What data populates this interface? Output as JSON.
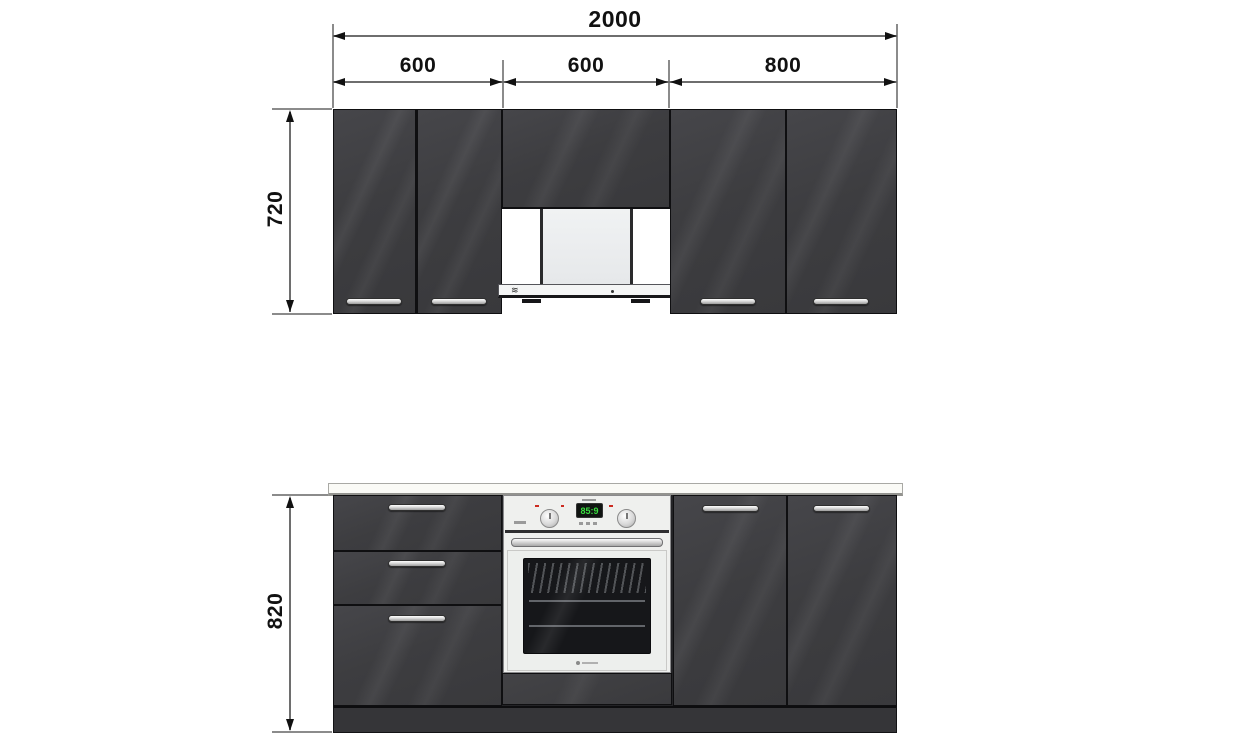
{
  "dimensions": {
    "total_width": "2000",
    "segment_left": "600",
    "segment_middle": "600",
    "segment_right": "800",
    "upper_cabinet_height": "720",
    "base_cabinet_height": "820"
  },
  "oven": {
    "display_value": "85:9"
  },
  "icons": {
    "hood_control_icon": "≋"
  },
  "colors": {
    "cabinet_dark": "#3d3d40",
    "cabinet_edge": "#0f0f11",
    "plinth": "#353538",
    "countertop": "#fafaf6",
    "countertop_edge": "#a9a9a5",
    "duct_fill": "#eceef0",
    "duct_edge": "#2a2a2c",
    "hood_face": "#f4f5f5",
    "oven_body": "#eff0ee",
    "oven_trim": "#8a8a8c",
    "oven_glass": "#16171a",
    "display_bg": "#101411",
    "display_green": "#3ade3f",
    "accent_red": "#cc2b20",
    "dim_line": "#6e6e6e",
    "dim_text": "#111111",
    "background": "#ffffff"
  }
}
